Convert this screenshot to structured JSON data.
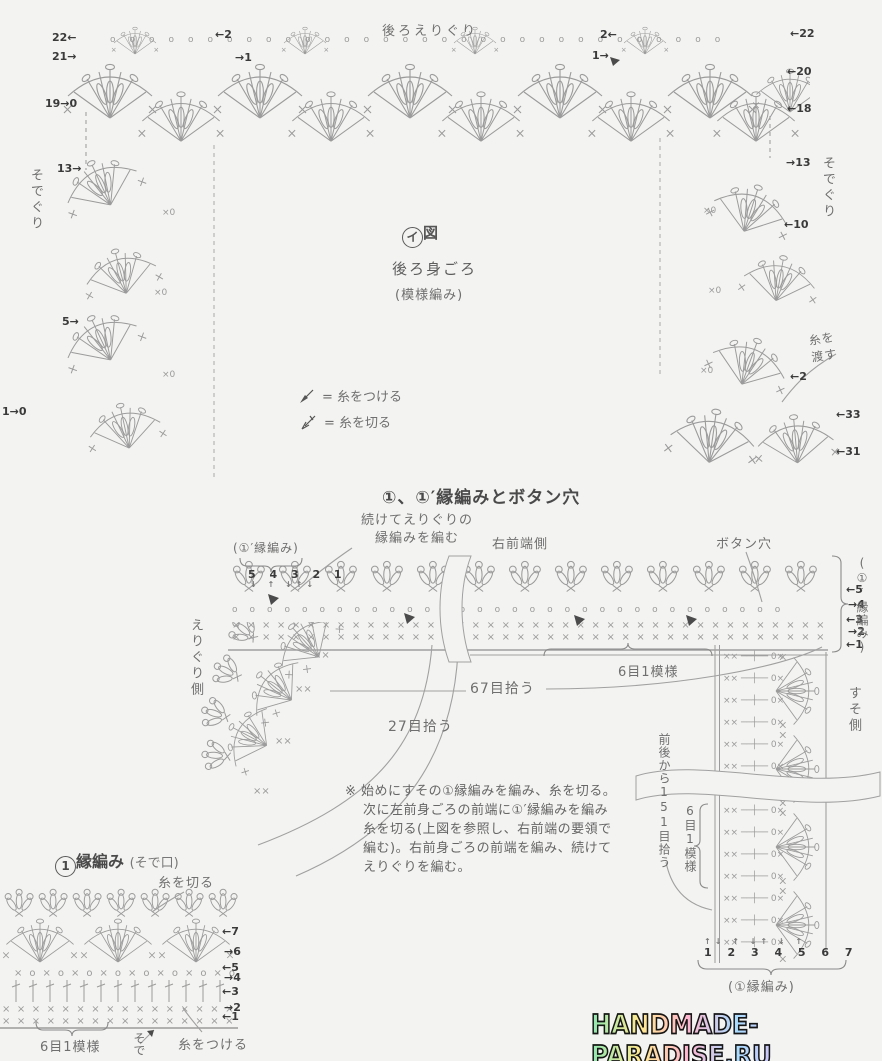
{
  "colors": {
    "paper": "#f3f3f1",
    "ink": "#9b9b9b",
    "label": "#6f6f6f",
    "strong": "#3a3a3a"
  },
  "top": {
    "neckline": "後ろえりぐり",
    "fig_circled": "イ",
    "fig_suffix": "図",
    "body": "後ろ身ごろ",
    "pattern": "(模様編み)",
    "armhole_left": "そでぐり",
    "armhole_right": "そでぐり",
    "yarn_carry": "糸を渡す",
    "legend": [
      {
        "label": "= 糸をつける"
      },
      {
        "label": "= 糸を切る"
      }
    ],
    "markers": {
      "tl": [
        "22←",
        "21→",
        "19→0"
      ],
      "tl_inner": [
        "←2",
        "→1"
      ],
      "tr_inner": [
        "2←",
        "1→"
      ],
      "tr": [
        "←22",
        "←20",
        "←18"
      ],
      "arm_l": [
        "13→",
        "5→",
        "1→0"
      ],
      "arm_r": [
        "→13",
        "←10",
        "←2",
        "←33",
        "←31"
      ]
    }
  },
  "mid": {
    "heading": "①、①′縁編みとボタン穴",
    "continue_note": "続けてえりぐりの\n縁編みを編む",
    "edge_label_left": "(①′縁編み)",
    "cols_nums": "5 4 3 2 1",
    "cols_arrows": "↓ ↑ ↓↑↓",
    "right_front": "右前端側",
    "buttonhole": "ボタン穴",
    "row_markers": [
      "←5",
      "→4",
      "←3",
      "→2",
      "←1"
    ],
    "edge_label_right": "(①′縁編み)",
    "neck_side": "えりぐり側",
    "pick27": "27目拾う",
    "pick67": "67目拾う",
    "rep6": "6目1模様",
    "hem_side": "すそ側",
    "pick151": "前後から151目拾う",
    "rep6_vert": "6目1模様",
    "note": [
      "※ 始めにすその①縁編みを編み、糸を切る。",
      "次に左前身ごろの前端に①′縁編みを編み",
      "糸を切る(上図を参照し、右前端の要領で",
      "編む)。右前身ごろの前端を編み、続けて",
      "えりぐりを編む。"
    ]
  },
  "bottom": {
    "heading_main": "縁編み",
    "heading_num": "1",
    "heading_sub": "(そで口)",
    "cut": "糸を切る",
    "attach": "糸をつける",
    "sleeve": "そで",
    "row_markers": [
      "←7",
      "→6",
      "←5",
      "→4",
      "←3",
      "→2",
      "←1"
    ],
    "rep6": "6目1模様",
    "stitch_nums": "1 2 3 4 5 6 7",
    "stitch_arrows": "↑↓ ↑ ↓↑ ↓ ↑",
    "edge_label": "(①縁編み)"
  },
  "watermark": "HANDMADE-PARADISE.RU",
  "artwork": {
    "x44": "×××××××××××××××××××××××××××××××××××××××××××",
    "x18": "××××××××××××××××××",
    "xo16": "×o×o×o×o×o×o×o×o",
    "oo": "oooooooooooooooooooooooooooooooo",
    "vrow": "×× ──┼── 0×",
    "x0": "×0",
    "x2": "××"
  }
}
